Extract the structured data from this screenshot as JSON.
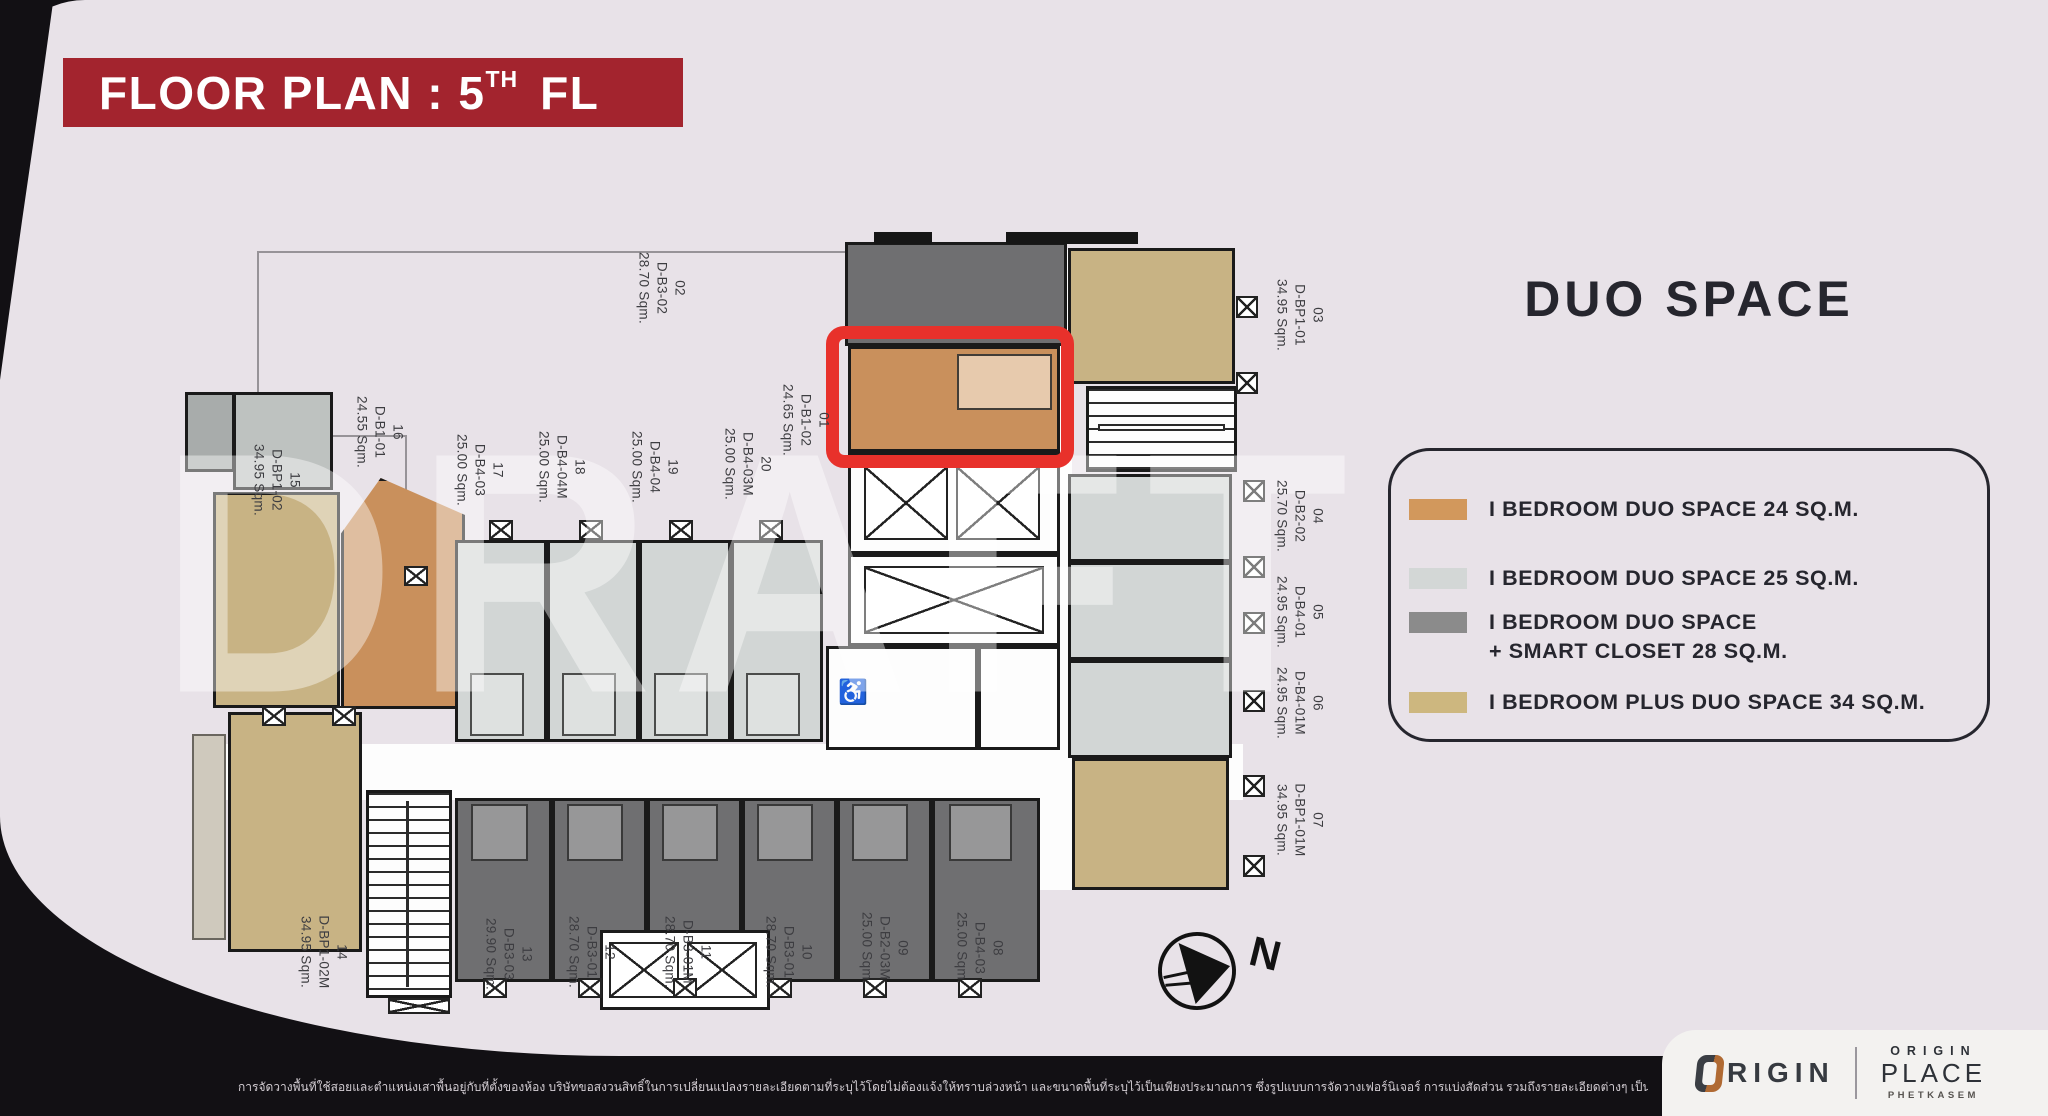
{
  "title": {
    "prefix": "FLOOR PLAN : 5",
    "superscript": "TH",
    "suffix": "FL"
  },
  "legend": {
    "title": "DUO SPACE",
    "items": [
      {
        "color": "#D2985C",
        "lines": [
          "I BEDROOM DUO SPACE 24 SQ.M."
        ]
      },
      {
        "color": "#D3D7D6",
        "lines": [
          "I BEDROOM DUO SPACE 25 SQ.M."
        ]
      },
      {
        "color": "#8B8B8B",
        "lines": [
          "I BEDROOM DUO SPACE",
          "+ SMART CLOSET 28 SQ.M."
        ]
      },
      {
        "color": "#CDB77F",
        "lines": [
          "I BEDROOM PLUS DUO SPACE 34 SQ.M."
        ]
      }
    ]
  },
  "plan": {
    "watermark": "DRAFT",
    "north_label": "N",
    "icons": {
      "accessible-wc": "♿"
    },
    "units": [
      {
        "no": "01",
        "model": "D-B1-02",
        "area": "24.65 Sqm."
      },
      {
        "no": "02",
        "model": "D-B3-02",
        "area": "28.70 Sqm."
      },
      {
        "no": "03",
        "model": "D-BP1-01",
        "area": "34.95 Sqm."
      },
      {
        "no": "04",
        "model": "D-B2-02",
        "area": "25.70 Sqm."
      },
      {
        "no": "05",
        "model": "D-B4-01",
        "area": "24.95 Sqm."
      },
      {
        "no": "06",
        "model": "D-B4-01M",
        "area": "24.95 Sqm."
      },
      {
        "no": "07",
        "model": "D-BP1-01M",
        "area": "34.95 Sqm."
      },
      {
        "no": "08",
        "model": "D-B4-03",
        "area": "25.00 Sqm."
      },
      {
        "no": "09",
        "model": "D-B2-03M",
        "area": "25.00 Sqm."
      },
      {
        "no": "10",
        "model": "D-B3-01",
        "area": "28.70 Sqm."
      },
      {
        "no": "11",
        "model": "D-B3-01M",
        "area": "28.70 Sqm."
      },
      {
        "no": "12",
        "model": "D-B3-01",
        "area": "28.70 Sqm."
      },
      {
        "no": "13",
        "model": "D-B3-03",
        "area": "29.90 Sqm."
      },
      {
        "no": "14",
        "model": "D-BP1-02M",
        "area": "34.95 Sqm."
      },
      {
        "no": "15",
        "model": "D-BP1-02",
        "area": "34.95 Sqm."
      },
      {
        "no": "16",
        "model": "D-B1-01",
        "area": "24.55 Sqm."
      },
      {
        "no": "17",
        "model": "D-B4-03",
        "area": "25.00 Sqm."
      },
      {
        "no": "18",
        "model": "D-B4-04M",
        "area": "25.00 Sqm."
      },
      {
        "no": "19",
        "model": "D-B4-04",
        "area": "25.00 Sqm."
      },
      {
        "no": "20",
        "model": "D-B4-03M",
        "area": "25.00 Sqm."
      }
    ]
  },
  "footer": {
    "disclaimer": "การจัดวางพื้นที่ใช้สอยและตำแหน่งเสาพื้นอยู่กับที่ตั้งของห้อง บริษัทขอสงวนสิทธิ์ในการเปลี่ยนแปลงรายละเอียดตามที่ระบุไว้โดยไม่ต้องแจ้งให้ทราบล่วงหน้า และขนาดพื้นที่ระบุไว้เป็นเพียงประมาณการ ซึ่งรูปแบบการจัดวางเฟอร์นิเจอร์ การแบ่งสัดส่วน รวมถึงรายละเอียดต่างๆ เป็นเพียงการแสดงตัวอย่างการจัดวางพื้นที่ใช้สอยเพื่อการโฆษณาเท่านั้น",
    "brand": {
      "origin_rest": "RIGIN",
      "place_top": "ORIGIN",
      "place_main": "PLACE",
      "place_sub": "PHETKASEM"
    }
  },
  "colors": {
    "banner": "#A3242E",
    "highlight": "#E8312B",
    "unit_orange": "#C9905C",
    "unit_light": "#D2D6D5",
    "unit_dark": "#6F6F71",
    "unit_tan": "#C8B384"
  }
}
